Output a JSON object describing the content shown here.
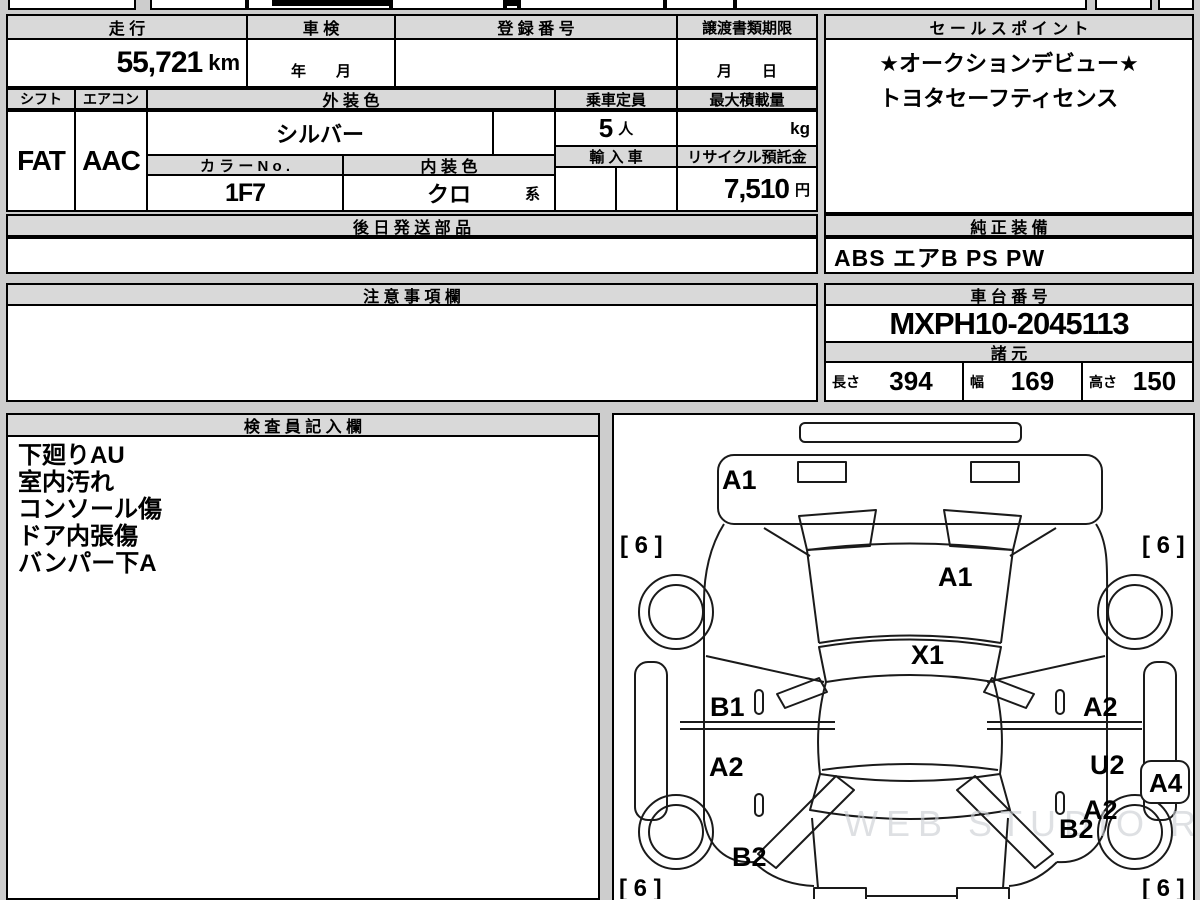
{
  "colors": {
    "page_bg": "#cdcdcd",
    "header_bg": "#d9d9d9",
    "border": "#000000",
    "watermark": "#c9cdd1"
  },
  "top_table": {
    "mileage_header": "走 行",
    "mileage_value": "55,721",
    "mileage_unit": "km",
    "shaken_header": "車 検",
    "shaken_placeholder": "年　　月",
    "registration_header": "登 録 番 号",
    "registration_value": "",
    "transfer_header": "譲渡書類期限",
    "transfer_placeholder": "月　　日",
    "shift_header": "シフト",
    "shift_value": "FAT",
    "aircon_header": "エアコン",
    "aircon_value": "AAC",
    "exterior_header": "外 装 色",
    "exterior_value": "シルバー",
    "capacity_header": "乗車定員",
    "capacity_value": "5",
    "capacity_unit": "人",
    "max_load_header": "最大積載量",
    "max_load_value": "",
    "max_load_unit": "kg",
    "color_no_header": "カ ラ ー N o .",
    "color_no_value": "1F7",
    "interior_header": "内 装 色",
    "interior_value": "クロ",
    "interior_suffix": "系",
    "import_header": "輸 入 車",
    "recycle_header": "リサイクル預託金",
    "recycle_value": "7,510",
    "recycle_unit": "円",
    "later_parts_header": "後 日 発 送 部 品",
    "later_parts_value": ""
  },
  "sales": {
    "header": "セ ー ル ス ポ イ ン ト",
    "lines": [
      "★オークションデビュー★",
      "トヨタセーフティセンス"
    ]
  },
  "equipment": {
    "header": "純 正 装 備",
    "value": "ABS エアB PS PW"
  },
  "caution": {
    "header": "注 意 事 項 欄",
    "value": ""
  },
  "chassis": {
    "header": "車 台 番 号",
    "value": "MXPH10-2045113"
  },
  "specs": {
    "header": "諸 元",
    "length_label": "長さ",
    "length_value": "394",
    "width_label": "幅",
    "width_value": "169",
    "height_label": "高さ",
    "height_value": "150"
  },
  "inspector": {
    "header": "検 査 員 記 入 欄",
    "lines": [
      "下廻りAU",
      "室内汚れ",
      "コンソール傷",
      "ドア内張傷",
      "バンパー下A"
    ]
  },
  "diagram": {
    "labels": {
      "front_bumper": "A1",
      "hood": "A1",
      "windshield": "X1",
      "left_front_door": "B1",
      "left_rear_door": "A2",
      "left_rear_quarter": "B2",
      "right_front_door": "A2",
      "right_rear_door": "U2",
      "right_rear_panel": "A2",
      "right_corner": "A4",
      "right_rear_quarter": "B2",
      "tire_front_left": "[ 6 ]",
      "tire_front_right": "[ 6 ]",
      "tire_rear_left": "[ 6 ]",
      "tire_rear_right": "[ 6 ]"
    },
    "watermark": "WEB STUDIO RIO"
  }
}
